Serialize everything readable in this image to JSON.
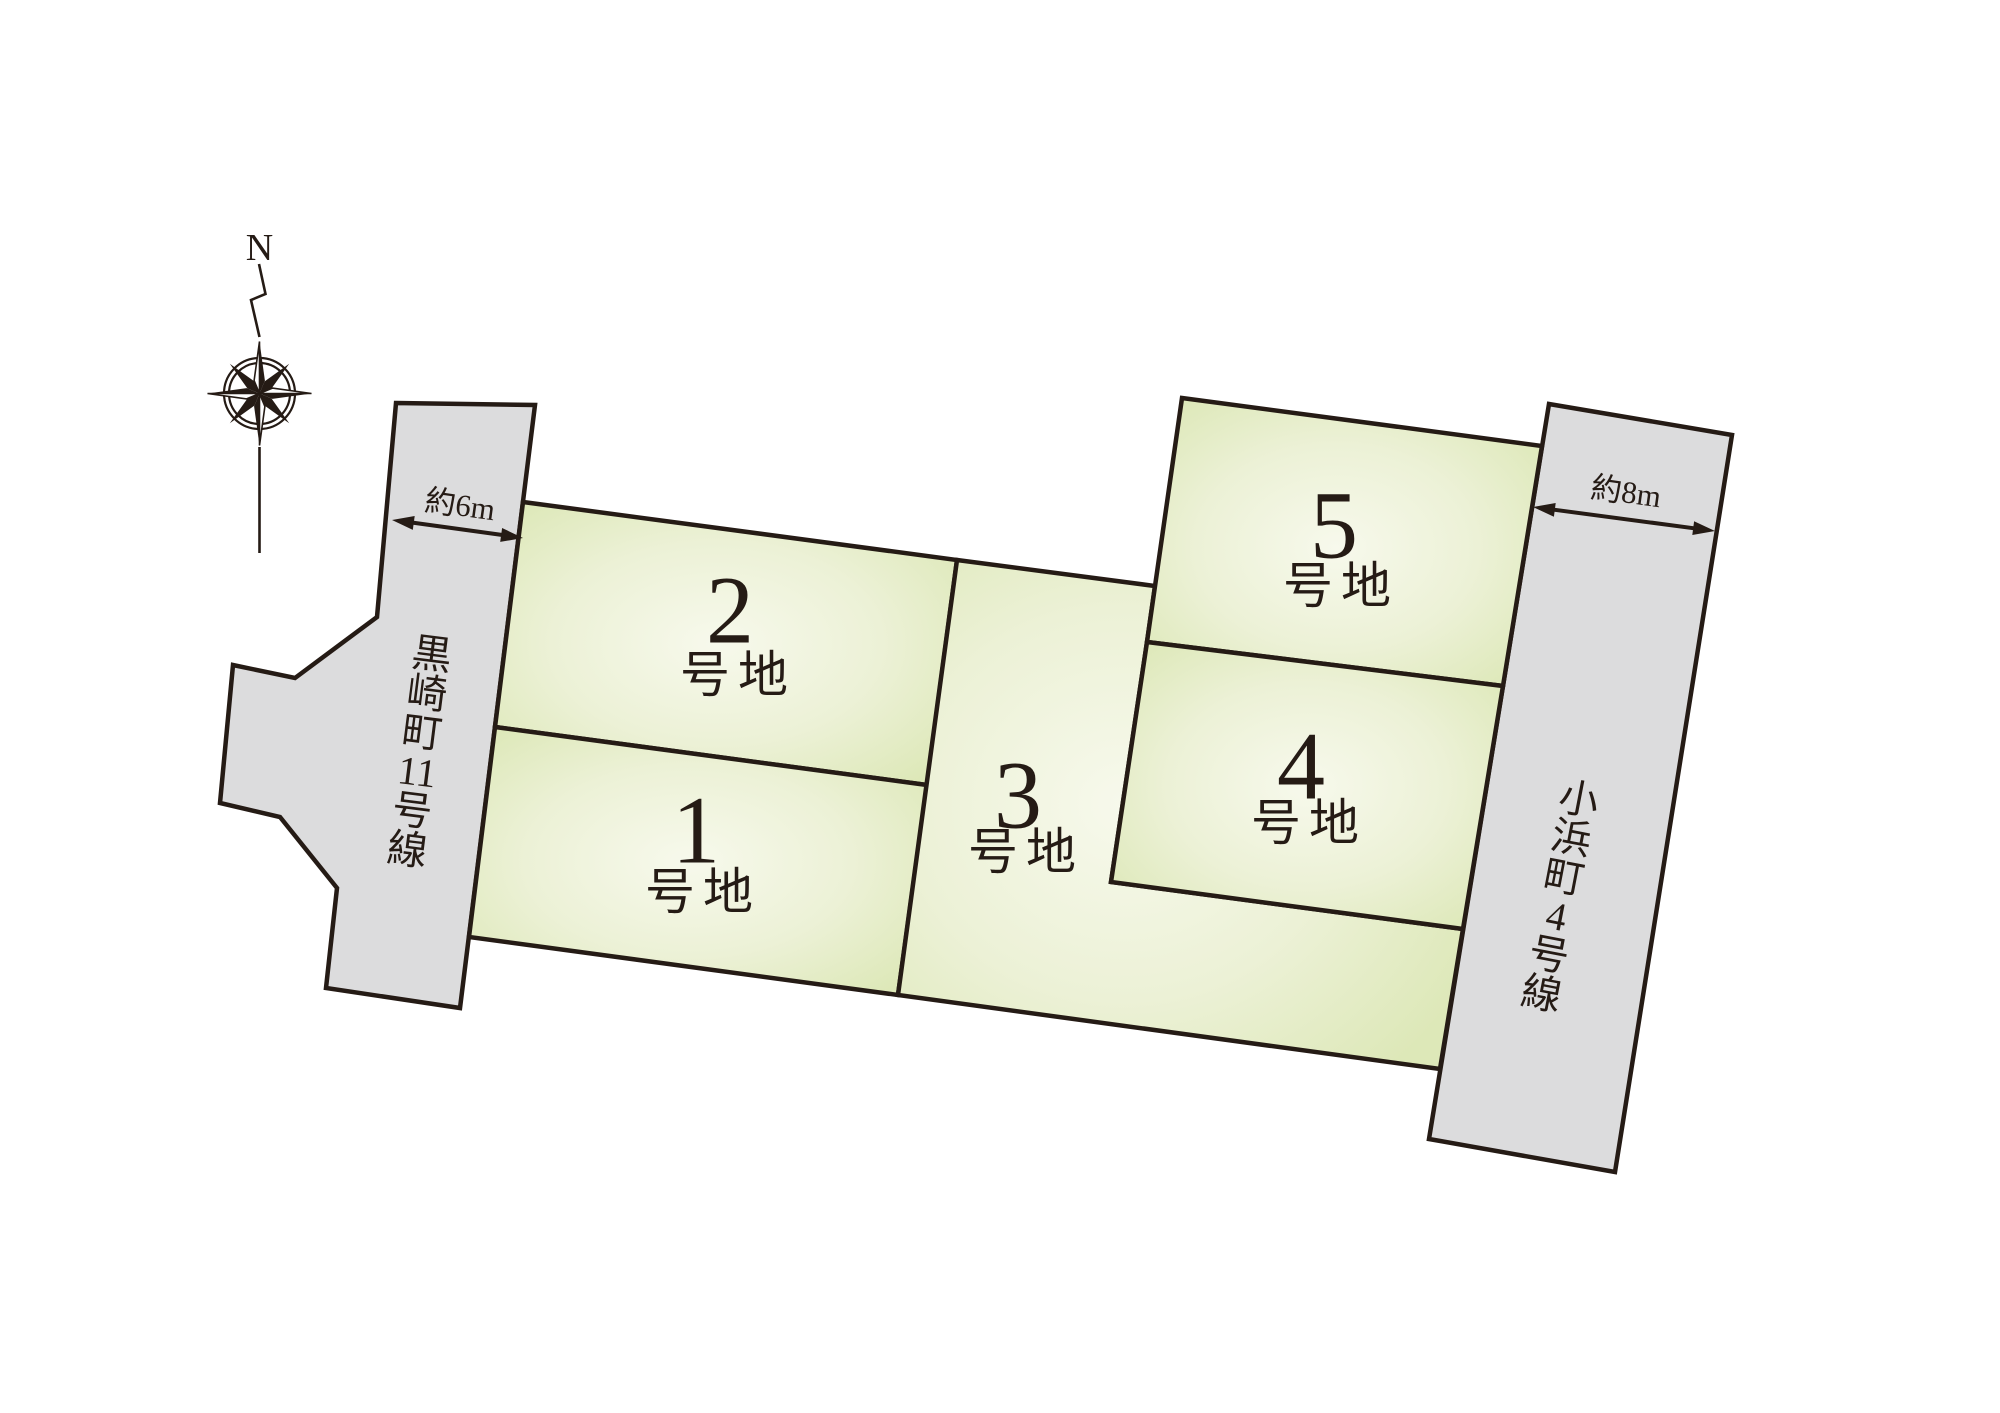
{
  "compass": {
    "north_label": "N"
  },
  "roads": {
    "left": {
      "name": "黒崎町11号線",
      "width_label": "約6m"
    },
    "right": {
      "name": "小浜町4号線",
      "width_label": "約8m"
    }
  },
  "lots": [
    {
      "number": "1",
      "suffix": "号地"
    },
    {
      "number": "2",
      "suffix": "号地"
    },
    {
      "number": "3",
      "suffix": "号地"
    },
    {
      "number": "4",
      "suffix": "号地"
    },
    {
      "number": "5",
      "suffix": "号地"
    }
  ],
  "colors": {
    "line": "#251b15",
    "road_fill": "#dcdcdd",
    "lot_edge": "#dde8b8",
    "lot_mid": "#ecf1d6",
    "lot_center": "#f7f9ec",
    "text": "#251b15",
    "bg": "#ffffff"
  }
}
